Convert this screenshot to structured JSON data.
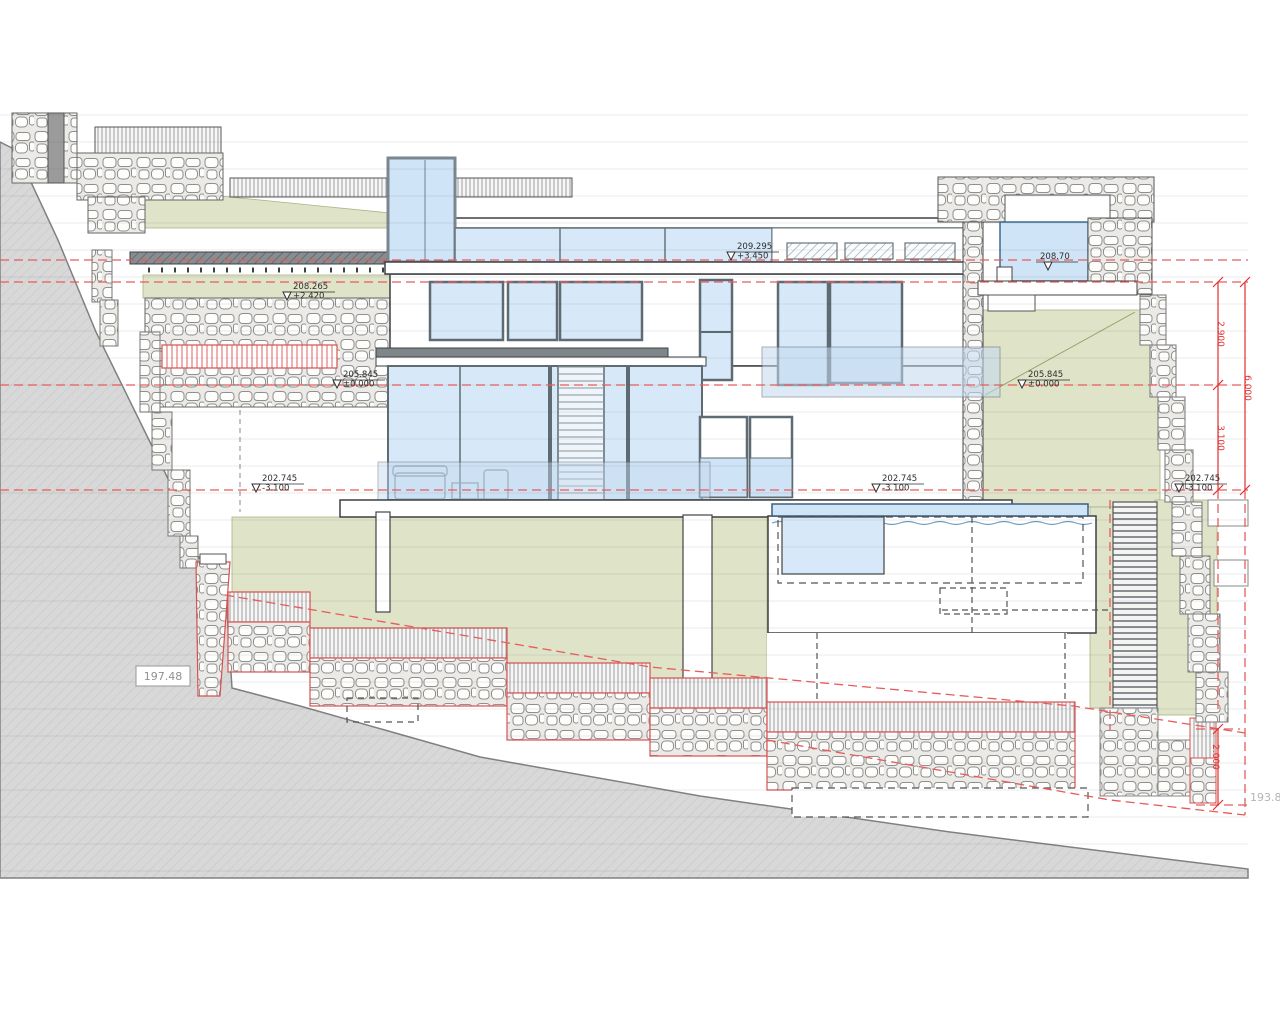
{
  "drawing": {
    "type": "architectural-section",
    "description": "Hillside villa cross-section with terraces, pools and retaining walls",
    "levels": [
      {
        "name": "roof",
        "value": "209.295",
        "offset": "+3.450"
      },
      {
        "name": "terrace-deck",
        "value": "208.265",
        "offset": "+2.420"
      },
      {
        "name": "upper-pool",
        "value": "208.70",
        "offset": ""
      },
      {
        "name": "main-floor-left",
        "value": "205.845",
        "offset": "±0.000"
      },
      {
        "name": "main-floor-right",
        "value": "205.845",
        "offset": "±0.000"
      },
      {
        "name": "lower-floor-left",
        "value": "202.745",
        "offset": "-3.100"
      },
      {
        "name": "lower-floor-mid",
        "value": "202.745",
        "offset": "-3.100"
      },
      {
        "name": "lower-floor-right",
        "value": "202.745",
        "offset": "-3.100"
      }
    ],
    "dimensions": {
      "upper_storey": "2.900",
      "lower_storey": "3.100",
      "total_height": "6.000",
      "bottom_wall": "2.000"
    },
    "spot_levels": {
      "terrain_left": "197.48",
      "terrain_right": "193.8"
    },
    "colors": {
      "dimension_red": "#e03030",
      "level_dash_red": "#e65c5c",
      "glass_blue": "#d7e9f8",
      "terrace_green": "#dfe3c8",
      "terrain_gray": "#d8d8d8"
    }
  }
}
